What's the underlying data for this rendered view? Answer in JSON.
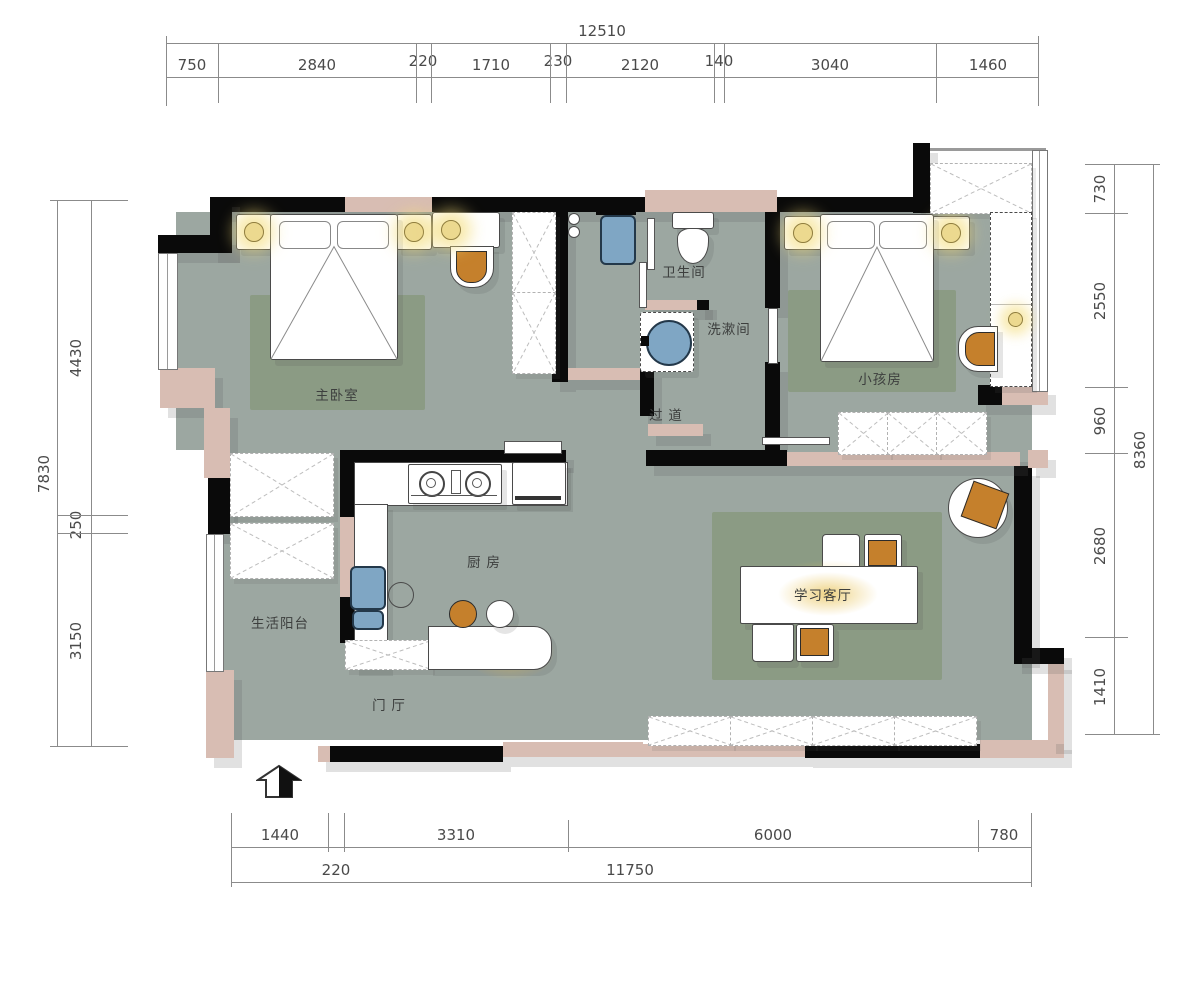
{
  "rooms": {
    "master_bedroom": "主卧室",
    "bathroom": "卫生间",
    "washroom": "洗漱间",
    "kids_room": "小孩房",
    "corridor": "过 道",
    "kitchen": "厨 房",
    "balcony": "生活阳台",
    "foyer": "门 厅",
    "study_living_room": "学习客厅"
  },
  "dims": {
    "top_total": "12510",
    "top_segments": [
      "750",
      "2840",
      "220",
      "1710",
      "230",
      "2120",
      "140",
      "3040",
      "1460"
    ],
    "left_total": "7830",
    "left_segments": [
      "4430",
      "250",
      "3150"
    ],
    "right_total": "8360",
    "right_segments": [
      "730",
      "2550",
      "960",
      "2680",
      "1410"
    ],
    "bottom_segments": [
      "1440",
      "3310",
      "6000",
      "780"
    ],
    "bottom_total_segments": [
      "220",
      "11750"
    ]
  },
  "colors": {
    "floor": "#9ca7a1",
    "rug": "#8b9b84",
    "wall": "#0a0a0a",
    "wall_infill": "#d8bdb3",
    "accent_orange": "#c5802c",
    "fixture_blue": "#7fa6c4",
    "lamp_glow": "#f3dc78"
  }
}
